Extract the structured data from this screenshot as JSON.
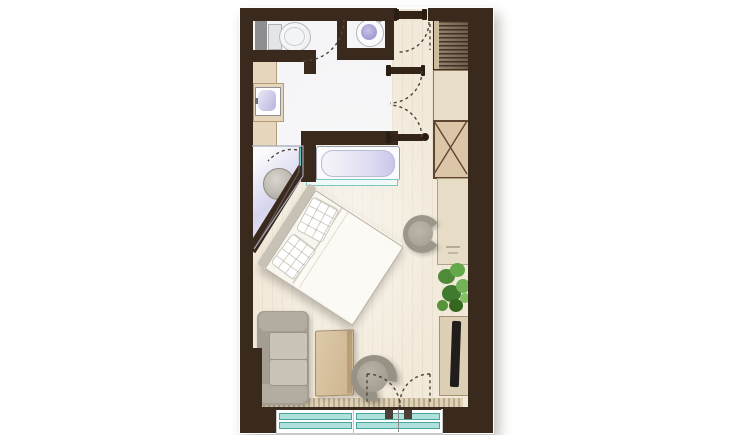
{
  "meta": {
    "title": "Studio hotel-room floor plan (top-down architectural rendering)",
    "visible_text": "none — drawing contains no labels or dimensions"
  },
  "palette": {
    "wall": "#3a2a1e",
    "wood_floor": "#f1e9d9",
    "bath_floor": "#f5f5f7",
    "glass_teal": "#8fd8d2",
    "furniture_wood": "#ddcbaa",
    "upholstery_gray": "#a9a39a",
    "sanitary_lavender": "#b5b1dd",
    "plant_green": "#5f9e3f"
  },
  "rooms": {
    "wc": {
      "label": "WC with toilet"
    },
    "washbasin_nook": {
      "label": "Washbasin nook"
    },
    "bathroom": {
      "label": "Bathroom with vanity, corner shower and bathtub"
    },
    "entry_hall": {
      "label": "Entry hall with wardrobe"
    },
    "living_sleeping": {
      "label": "Combined sleeping / living room"
    },
    "balcony_front": {
      "label": "Window wall with French doors"
    }
  },
  "fixtures": {
    "toilet": "Toilet",
    "shaft": "Service shaft",
    "washbasin": "Round washbasin",
    "vanity": "Vanity counter with sink",
    "shower": "Corner shower",
    "shower_stool": "Shower stool / drain",
    "shower_door": "Glass shower door",
    "bathtub": "Bathtub",
    "tub_glass": "Glass partition at bathtub",
    "entry_door": "Entry door (swing)",
    "double_doors": "Double swing doors to hall",
    "wardrobe": "Wardrobe with hanging rail",
    "cabinet": "Closed cabinet",
    "bench": "Storage bench (X symbol)",
    "desk": "Desk / console",
    "desk_chair": "Tub chair at desk",
    "bed": "Double bed placed diagonally",
    "pillow": "Pillow",
    "plant": "Potted plant",
    "tv_console": "TV sideboard",
    "tv": "Television",
    "sofa": "Sofa",
    "coffee_table": "Coffee table",
    "armchair": "Tub armchair",
    "rug": "Runner / threshold strip",
    "window": "Fixed glazing",
    "french_doors": "Glazed French doors"
  }
}
